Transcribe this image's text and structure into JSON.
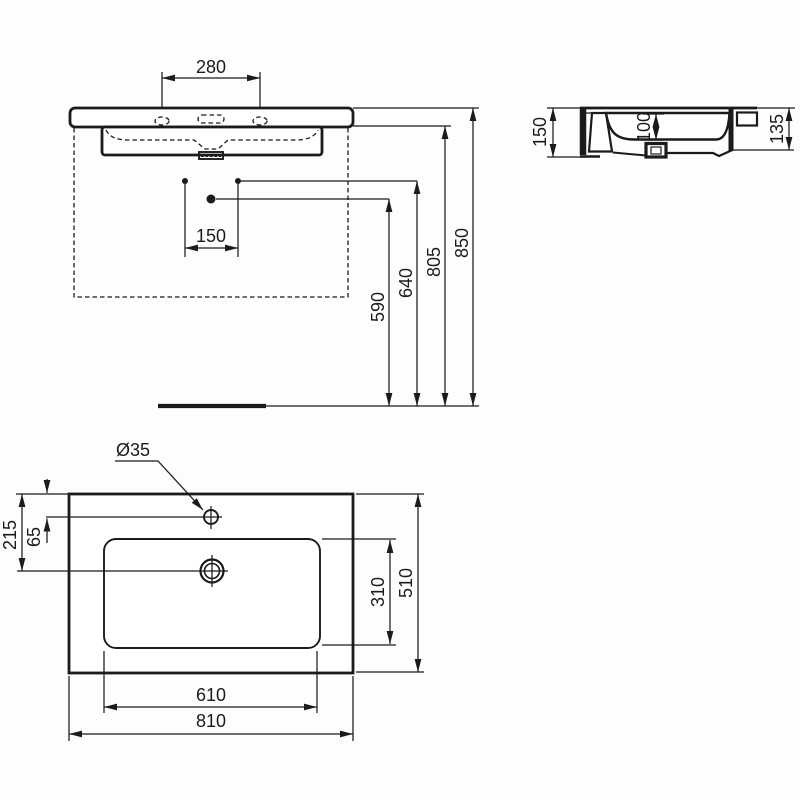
{
  "title": "Washbasin dimensional drawing",
  "colors": {
    "line": "#1b1b1b",
    "background": "#fdfdfd"
  },
  "front": {
    "tap_spacing": "280",
    "hole_spacing": "150",
    "drain_height": "590",
    "supply_height": "640",
    "rim_bottom_height": "805",
    "overall_height": "850"
  },
  "side": {
    "front_height": "150",
    "bowl_depth": "100",
    "rear_height": "135"
  },
  "plan": {
    "tap_hole_dia": "Ø35",
    "drain_setback": "215",
    "tap_setback": "65",
    "bowl_inner_depth": "310",
    "overall_depth": "510",
    "bowl_inner_width": "610",
    "overall_width": "810"
  }
}
